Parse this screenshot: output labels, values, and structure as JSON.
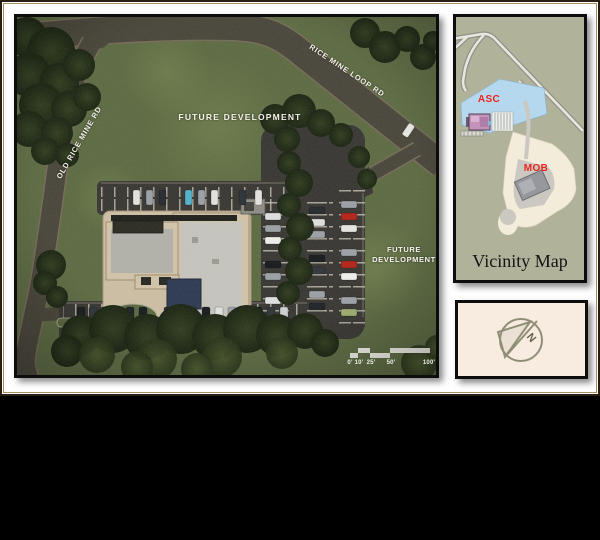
{
  "site_plan": {
    "road_labels": {
      "rice_mine_loop": "RICE MINE LOOP RD",
      "old_rice_mine": "OLD RICE MINE RD"
    },
    "area_labels": {
      "future_development_center": "FUTURE DEVELOPMENT",
      "future_development_right_line1": "FUTURE",
      "future_development_right_line2": "DEVELOPMENT"
    },
    "scale_bar": {
      "labels": [
        "0'",
        "10'",
        "25'",
        "50'",
        "100'"
      ]
    },
    "colors": {
      "grass": "#5b6941",
      "road": "#474339",
      "parking_asphalt": "#363431",
      "building_wall": "#d3c4aa",
      "building_roof": "#c6c5bf",
      "entry_canopy_navy": "#2b3751"
    }
  },
  "vicinity_map": {
    "title": "Vicinity Map",
    "site_labels": {
      "asc": "ASC",
      "mob": "MOB"
    },
    "colors": {
      "map_background": "#b1b29a",
      "asc_site_blue": "#b5d8ee",
      "mob_site_cream": "#f3ecdb",
      "label_red": "#e8211d"
    }
  },
  "compass": {
    "north_label": "N"
  }
}
